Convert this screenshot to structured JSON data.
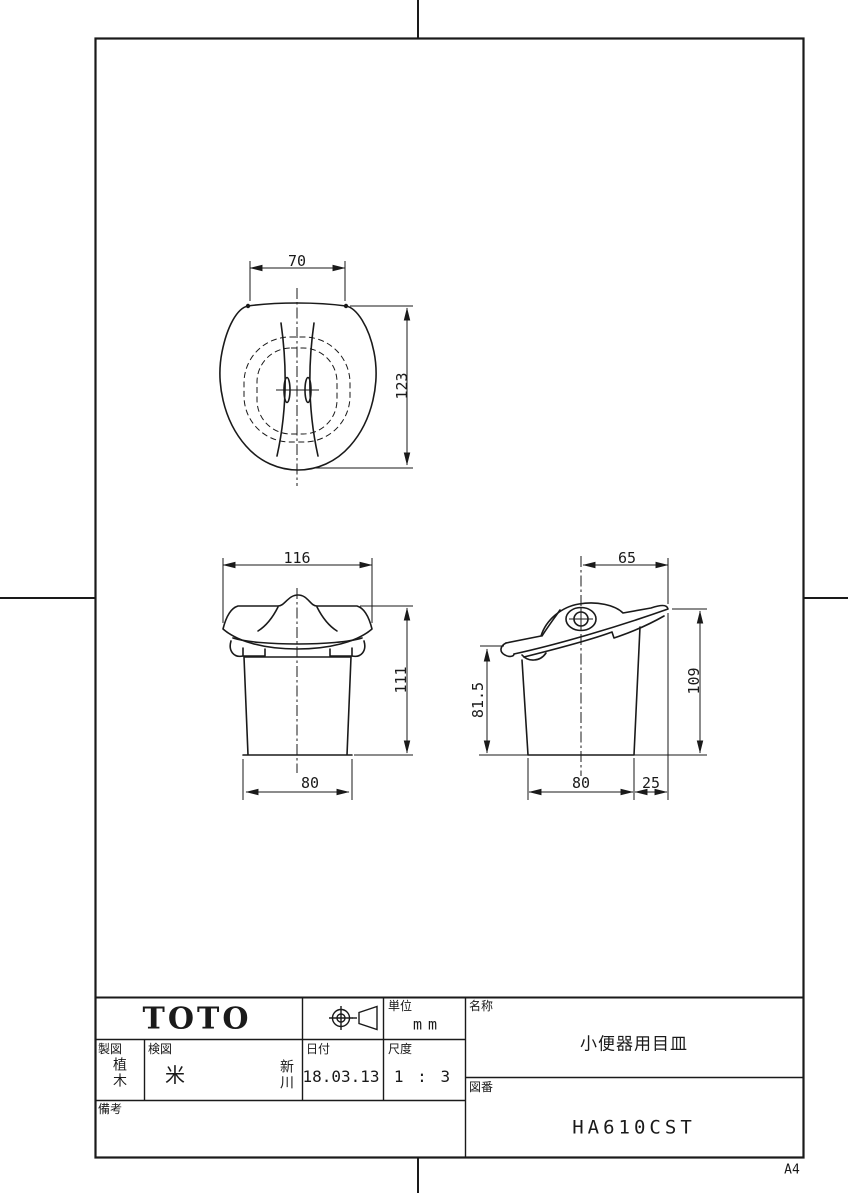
{
  "page": {
    "paper_size_label": "A4"
  },
  "title_block": {
    "logo_text": "TOTO",
    "projection_symbol": "third-angle-projection",
    "unit": {
      "label": "単位",
      "value": "mm"
    },
    "drafter": {
      "label": "製図",
      "stamp": "植木"
    },
    "checker": {
      "label": "検図",
      "stamps": [
        "米",
        "新川"
      ]
    },
    "date": {
      "label": "日付",
      "value": "18.03.13"
    },
    "scale": {
      "label": "尺度",
      "value": "1 : 3"
    },
    "remarks": {
      "label": "備考",
      "value": ""
    },
    "name": {
      "label": "名称",
      "value": "小便器用目皿"
    },
    "drawing_number": {
      "label": "図番",
      "value": "HA610CST"
    }
  },
  "views": {
    "top_view": {
      "dims": {
        "width": "70",
        "height": "123"
      }
    },
    "front_view": {
      "dims": {
        "top_width": "116",
        "height": "111",
        "bottom_width": "80"
      }
    },
    "side_view": {
      "dims": {
        "top_width": "65",
        "left_height": "81.5",
        "right_height": "109",
        "bottom_width": "80",
        "bottom_offset": "25"
      }
    }
  }
}
